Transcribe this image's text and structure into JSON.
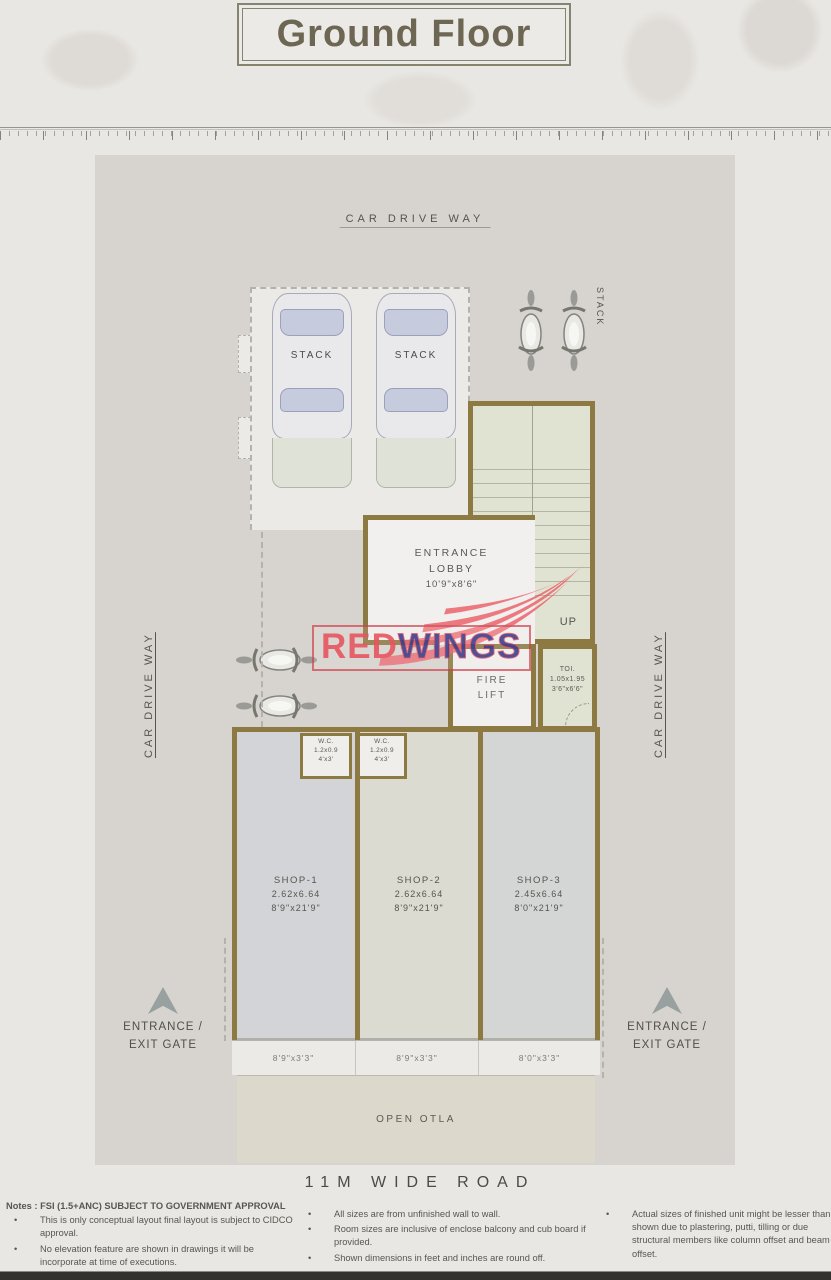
{
  "title": "Ground Floor",
  "watermark": {
    "red": "RED",
    "wings": "WINGS"
  },
  "plan": {
    "car_drive_way_top": "CAR DRIVE WAY",
    "car_drive_way_left": "CAR DRIVE WAY",
    "car_drive_way_right": "CAR DRIVE WAY",
    "stack_car_1": "STACK",
    "stack_car_2": "STACK",
    "stack_bikes": "STACK",
    "lobby": {
      "line1": "ENTRANCE",
      "line2": "LOBBY",
      "dim": "10'9\"x8'6\""
    },
    "up": "UP",
    "fire_lift": {
      "line1": "FIRE",
      "line2": "LIFT"
    },
    "toilet": {
      "name": "TOI.",
      "dim_m": "1.05x1.95",
      "dim_ft": "3'6\"x6'6\""
    },
    "wcs": [
      {
        "name": "W.C.",
        "dim_m": "1.2x0.9",
        "dim_ft": "4'x3'"
      },
      {
        "name": "W.C.",
        "dim_m": "1.2x0.9",
        "dim_ft": "4'x3'"
      }
    ],
    "shops": [
      {
        "name": "SHOP-1",
        "dim_m": "2.62x6.64",
        "dim_ft": "8'9\"x21'9\"",
        "front": "8'9\"x3'3\""
      },
      {
        "name": "SHOP-2",
        "dim_m": "2.62x6.64",
        "dim_ft": "8'9\"x21'9\"",
        "front": "8'9\"x3'3\""
      },
      {
        "name": "SHOP-3",
        "dim_m": "2.45x6.64",
        "dim_ft": "8'0\"x21'9\"",
        "front": "8'0\"x3'3\""
      }
    ],
    "gate_left": {
      "line1": "ENTRANCE /",
      "line2": "EXIT GATE"
    },
    "gate_right": {
      "line1": "ENTRANCE /",
      "line2": "EXIT GATE"
    },
    "open_otla": "OPEN OTLA",
    "road": "11M WIDE ROAD"
  },
  "notes": {
    "header": "Notes : FSI (1.5+ANC) SUBJECT TO GOVERNMENT APPROVAL",
    "col1": [
      "This is only conceptual layout final layout is subject to CIDCO approval.",
      "No elevation feature are shown in drawings it will be incorporate at time of executions."
    ],
    "col2": [
      "All sizes are from unfinished wall to wall.",
      "Room sizes are inclusive of enclose balcony and cub board if provided.",
      "Shown dimensions in feet and inches are round off."
    ],
    "col3": [
      "Actual sizes of finished unit might be lesser than shown due to plastering, putti, tilling or due structural members like column offset and beam offset."
    ]
  },
  "colors": {
    "wall": "#8d7a42",
    "plan_background": "#d7d3ce",
    "page_background": "#e9e7e3",
    "room_green": "#e0e3d2",
    "logo_red": "#e85660",
    "logo_blue": "#3f3f8e"
  }
}
